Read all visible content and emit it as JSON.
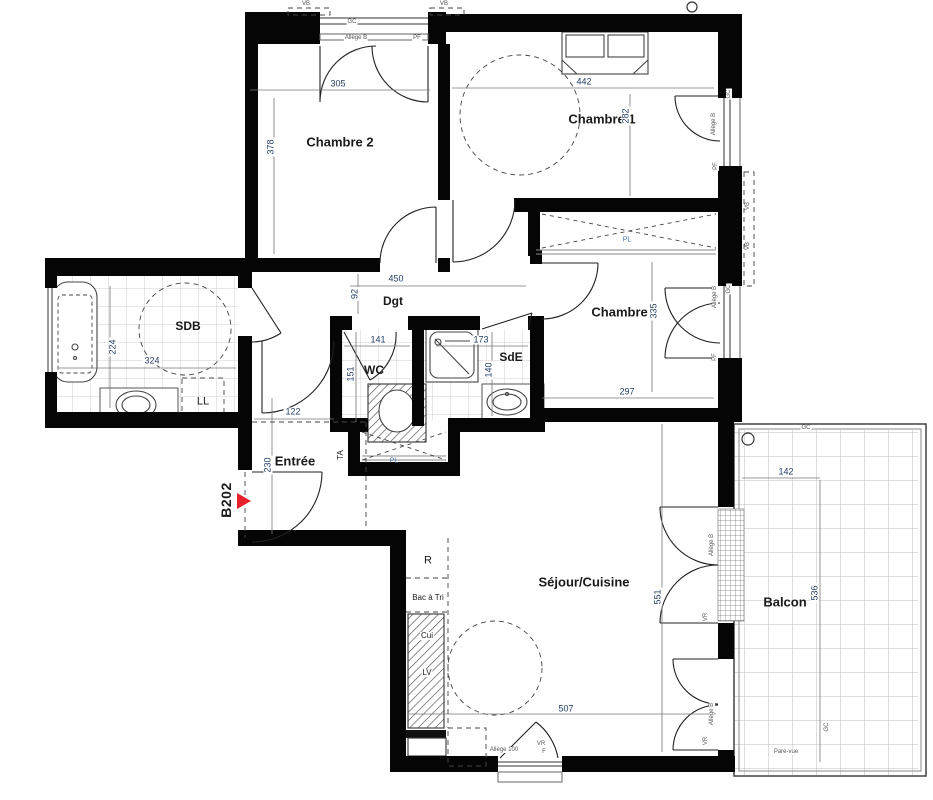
{
  "unit": {
    "label": "B202"
  },
  "rooms": {
    "chambre2": "Chambre 2",
    "chambre1": "Chambre 1",
    "chambre3": "Chambre 3",
    "sdb": "SDB",
    "wc": "WC",
    "sde": "SdE",
    "dgt": "Dgt",
    "entree": "Entrée",
    "sejour": "Séjour/Cuisine",
    "balcon": "Balcon"
  },
  "dims": {
    "chambre2_w": "305",
    "chambre2_h": "378",
    "chambre1_w": "442",
    "chambre1_h": "282",
    "chambre3_h": "335",
    "chambre3_w": "297",
    "dgt_w": "450",
    "dgt_h": "92",
    "sdb_w": "324",
    "sdb_h": "224",
    "wc_w": "141",
    "wc_h": "151",
    "sde_w": "173",
    "sde_h": "140",
    "entree_w": "122",
    "entree_h": "230",
    "sejour_w": "507",
    "sejour_h": "551",
    "balcon_w": "142",
    "balcon_h": "536"
  },
  "fixtures": {
    "washing_machine": "LL",
    "fridge": "R",
    "sorting_bin": "Bac à Tri",
    "cooker": "Cui",
    "dishwasher": "LV",
    "electrical_panel": "TA",
    "closet": "PL"
  },
  "annotations": {
    "gc": "GC",
    "vb": "VB",
    "pf": "PF",
    "allege_b": "Allège B",
    "allege_100": "Allège 100",
    "vr": "VR",
    "f": "F",
    "pare_vue": "Pare-vue"
  },
  "colors": {
    "wall": "#000000",
    "dim_text": "#1e3a5f",
    "accent_red": "#e8212a",
    "closet_text": "#4472aa",
    "annotation_text": "#555555"
  }
}
